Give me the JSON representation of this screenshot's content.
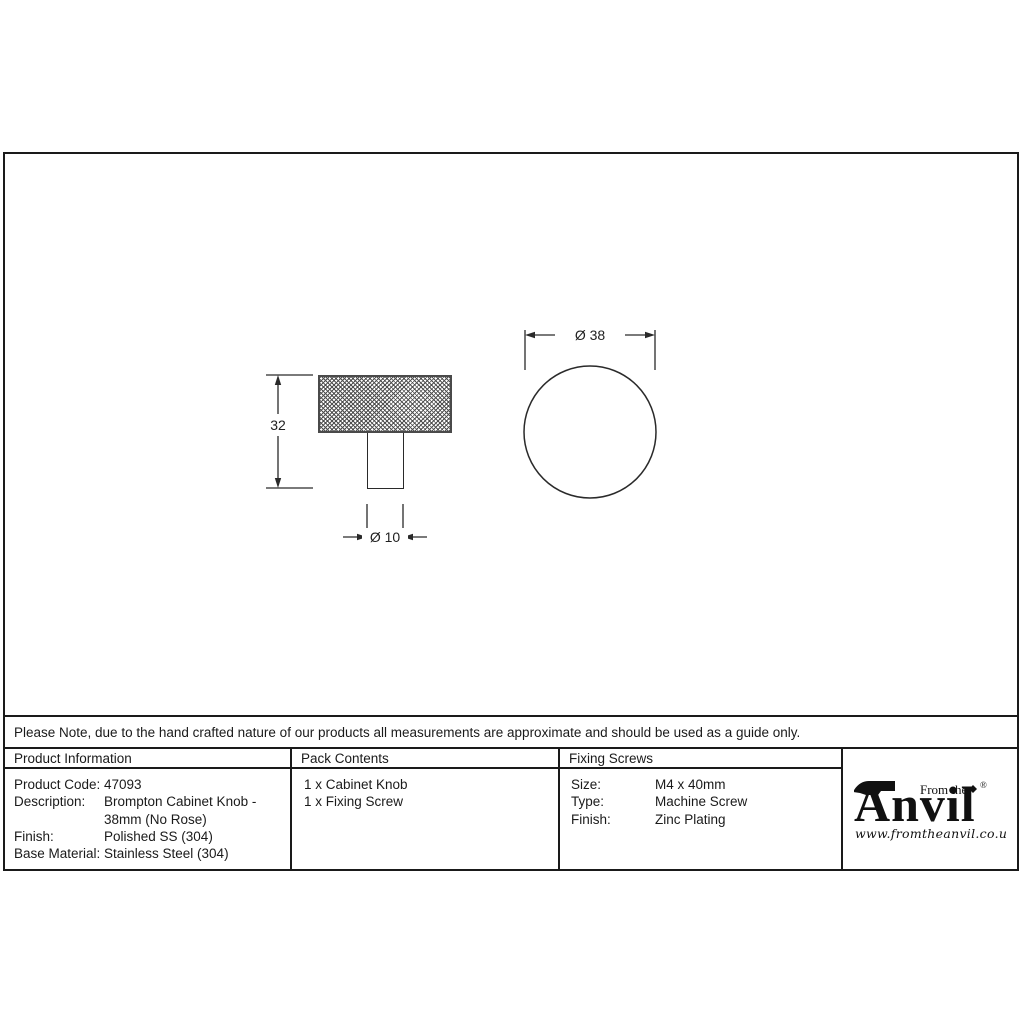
{
  "drawing": {
    "side_view": {
      "height_label": "32",
      "stem_diameter_label": "Ø 10"
    },
    "top_view": {
      "diameter_label": "Ø 38"
    }
  },
  "note": {
    "text": "Please Note, due to the hand crafted nature of our products all measurements are approximate and should be used as a guide only."
  },
  "table": {
    "product_information": {
      "header": "Product Information",
      "rows": [
        {
          "label": "Product Code:",
          "value": "47093"
        },
        {
          "label": "Description:",
          "value": "Brompton Cabinet Knob - 38mm (No Rose)"
        },
        {
          "label": "Finish:",
          "value": "Polished SS (304)"
        },
        {
          "label": "Base Material:",
          "value": "Stainless Steel (304)"
        }
      ]
    },
    "pack_contents": {
      "header": "Pack Contents",
      "items": [
        "1 x Cabinet Knob",
        "1 x Fixing Screw"
      ]
    },
    "fixing_screws": {
      "header": "Fixing Screws",
      "rows": [
        {
          "label": "Size:",
          "value": "M4 x 40mm"
        },
        {
          "label": "Type:",
          "value": "Machine Screw"
        },
        {
          "label": "Finish:",
          "value": "Zinc Plating"
        }
      ]
    }
  },
  "logo": {
    "tagline": "From the",
    "brand": "Anvil",
    "registered": "®",
    "url": "www.fromtheanvil.co.uk"
  },
  "colors": {
    "line": "#1a1a1a",
    "text": "#1a1a1a",
    "knurl": "#4f4f4f",
    "background": "#ffffff"
  }
}
